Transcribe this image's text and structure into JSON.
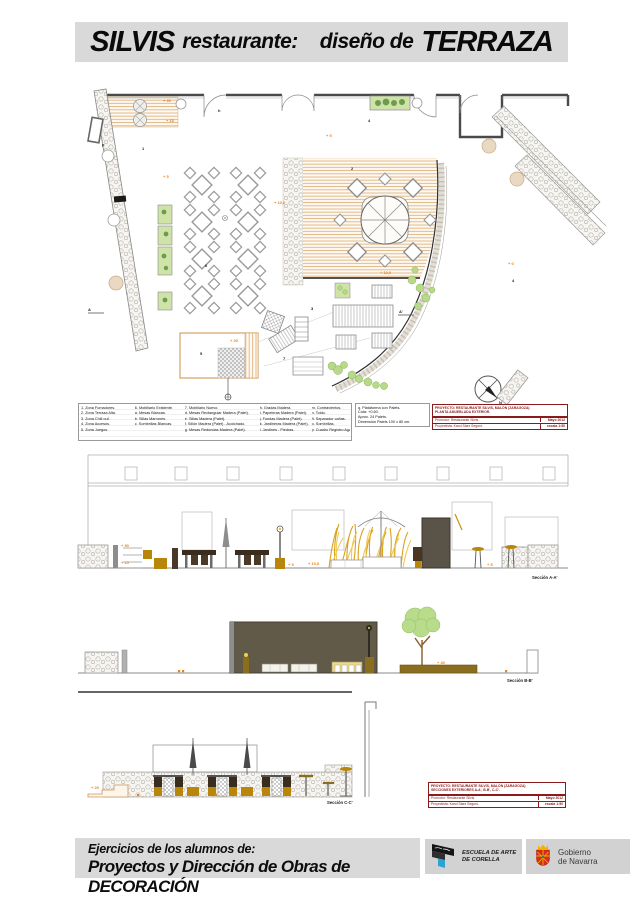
{
  "title": {
    "part1": "SILVIS",
    "part2": "restaurante:",
    "part3": "diseño de",
    "part4": "TERRAZA"
  },
  "legend": {
    "columns": [
      {
        "items": [
          "1. Zona Fumadores.",
          "2. Zona Terraza Alta.",
          "3. Zona Chill out.",
          "4. Zona Accesos.",
          "5. Zona Juegos."
        ]
      },
      {
        "items": [
          "6. Mobiliario Existente.",
          "a. Mesas Blancas.",
          "b. Sillas Marrones.",
          "c. Sombrillas Blancas."
        ]
      },
      {
        "items": [
          "7. Mobiliario Nuevo.",
          "d. Mesas Rectangular Madera (Palet).",
          "e. Sillas Madera (Palet).",
          "f. Sillón Madera (Palet) - Acolchado.",
          "g. Mesas Redondas Madera (Palet)."
        ]
      },
      {
        "items": [
          "h. Gradas Madera.",
          "i. Papeleras Madera (Palet).",
          "j. Fundas Madera (Palet).",
          "k. Jardineras Madera (Palet).",
          "l. Jardines - Piedras."
        ]
      },
      {
        "items": [
          "m. Contravientos.",
          "n. Toldo.",
          "ñ. Separador cañas.",
          "o. Sombrillas.",
          "p. Cuadro Registro Agua."
        ]
      }
    ]
  },
  "palets_box": {
    "lines": [
      "q. Plataforma con Palets.",
      "Cota: +0,60.",
      "Aprox. 24 Palets.",
      "Dimensión Palets 100 x 80 cm."
    ]
  },
  "title_block_top": {
    "line1": "PROYECTO: RESTAURANTE SILVIS, MALÓN (ZARAGOZA)",
    "line2": "PLANTA AMUEBLADA EXTERIOR.",
    "promotor": "Promotor: Restaurante Silvis.",
    "date": "Mayo 2012",
    "proyectista": "Proyectista: Karol Sáez Seguro.",
    "escala": "escala 1:50"
  },
  "title_block_bottom": {
    "line1": "PROYECTO: RESTAURANTE SILVIS, MALÓN (ZARAGOZA)",
    "line2": "SECCIONES EXTERIORES A-A', B-B', C-C'.",
    "promotor": "Promotor: Restaurante Silvis.",
    "date": "Mayo 2012",
    "proyectista": "Proyectista: Karol Sáez Seguro.",
    "escala": "escala 1:50"
  },
  "sections": {
    "a_label": "Sección A-A'",
    "b_label": "Sección B-B'",
    "c_label": "Sección C-C'"
  },
  "labels": {
    "plus90": "+ 90",
    "plus15": "+ 15",
    "plus5": "+ 5",
    "plus10": "+ 10,0",
    "plus20": "+ 20",
    "plus0": "+ 0",
    "plus40": "+ 40",
    "h": "h",
    "p": "p",
    "n": "N",
    "a": "A",
    "a_prime": "A'",
    "z1": "1",
    "z2": "2",
    "z3": "3",
    "z4": "4",
    "z5": "5",
    "z6": "6",
    "z7": "7"
  },
  "footer": {
    "line1": "Ejercicios de los alumnos de:",
    "line2": "Proyectos y Dirección de Obras de DECORACIÓN"
  },
  "logos": {
    "escuela": {
      "line1": "ESCUELA DE ARTE",
      "line2": "DE CORELLA"
    },
    "navarra": {
      "line1": "Gobierno",
      "line2": "de Navarra"
    }
  },
  "colors": {
    "strip_gray": "#d9d9d9",
    "accent_orange": "#e8821e",
    "title_red": "#8b1a1a",
    "deck_tan": "#d9a96a",
    "ochre": "#b8860b",
    "dark_wood": "#3d2e1e",
    "building_olive": "#615a48",
    "reed_gold": "#d9a21a",
    "plant_green": "#b8d98a",
    "navarra_red": "#d52b1e",
    "escuela_cyan": "#2ba3d4"
  }
}
